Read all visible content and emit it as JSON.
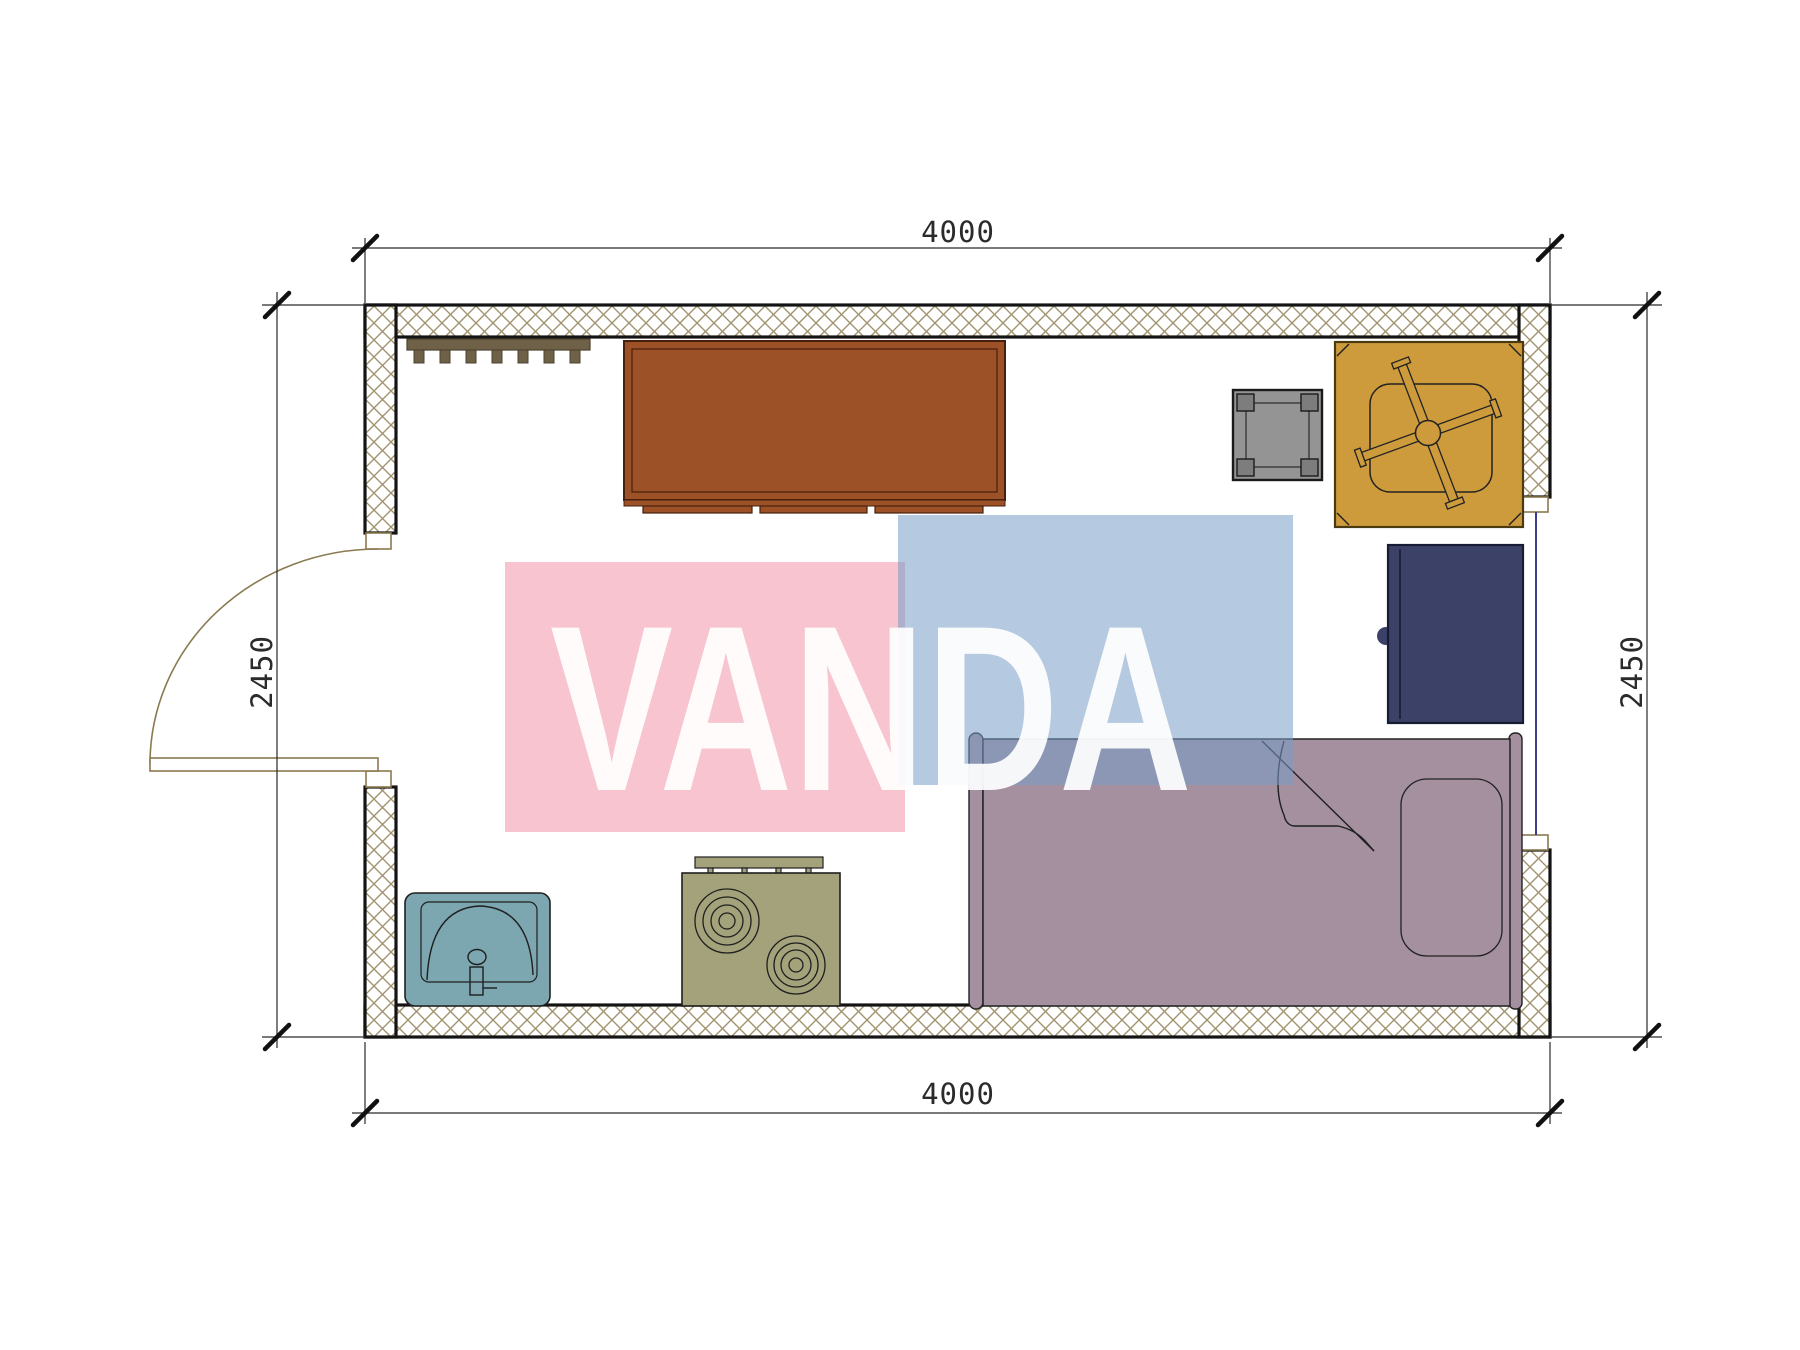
{
  "title": "studio container floor plan",
  "watermark": {
    "text": "VANDA"
  },
  "dimensions": {
    "top": "4000",
    "bottom": "4000",
    "left": "2450",
    "right": "2450"
  },
  "plan_contents": {
    "furniture": [
      "coat-rack",
      "wardrobe",
      "stool",
      "office-chair",
      "nightstand",
      "bed-with-pillow",
      "sink",
      "stove"
    ],
    "openings": [
      "entry-door-left",
      "window-right"
    ]
  },
  "colors": {
    "hatch": "#a2936f",
    "wall-border": "#141414",
    "line": "#1f1f1f",
    "dim": "#2a2a2a",
    "door": "#8a7a50",
    "window": "#3d3d8f",
    "coat-rack": "#6f6147",
    "coat-rack-dark": "#4e4330",
    "wardrobe": "#9c5127",
    "wardrobe-border": "#46200c",
    "stool": "#949494",
    "stool-dark": "#7d7d7d",
    "chair": "#cd9b3c",
    "chair-border": "#4a3a10",
    "nightstand": "#3c4168",
    "nightstand-border": "#181c33",
    "bed": "#a4909f",
    "sink": "#7ca6b0",
    "stove": "#a3a27b",
    "wm-pink": "rgba(242,160,178,0.62)",
    "wm-blue": "rgba(120,157,199,0.55)",
    "wm-text": "rgba(255,255,255,0.92)"
  }
}
